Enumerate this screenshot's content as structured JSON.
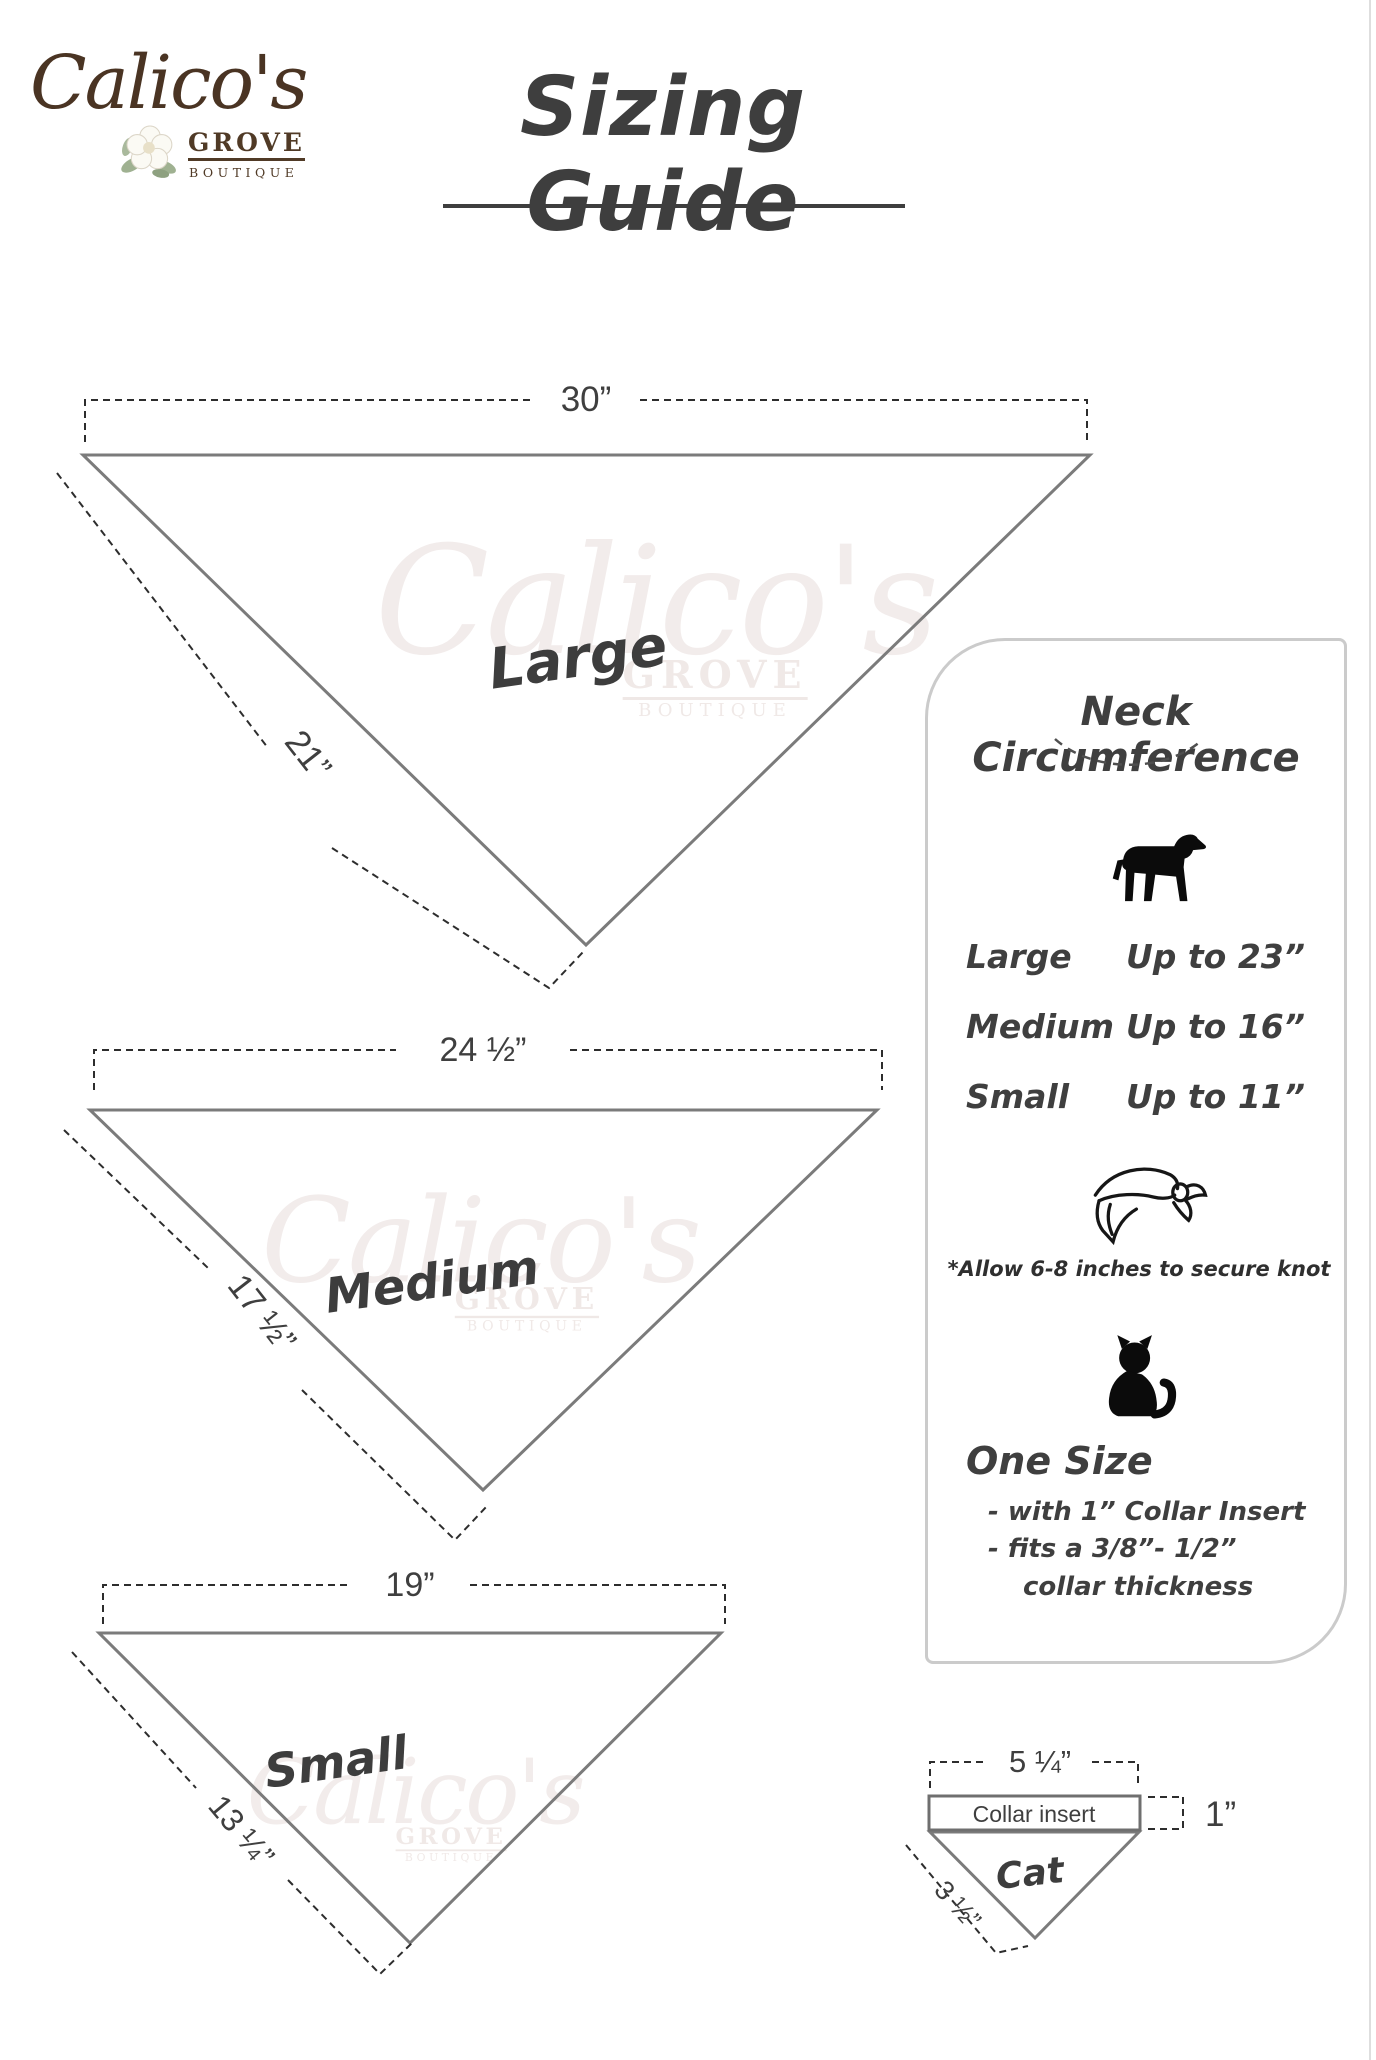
{
  "logo": {
    "name": "Calico's",
    "grove": "GROVE",
    "boutique": "BOUTIQUE",
    "flower_icon": "magnolia-flower",
    "brand_color": "#4a3423"
  },
  "title": {
    "text": "Sizing Guide"
  },
  "watermark": {
    "script": "Calico's",
    "grove": "GROVE",
    "boutique": "BOUTIQUE"
  },
  "bandanas": [
    {
      "label": "Large",
      "top_width": "30”",
      "side_length": "21”"
    },
    {
      "label": "Medium",
      "top_width": "24 ½”",
      "side_length": "17 ½”"
    },
    {
      "label": "Small",
      "top_width": "19”",
      "side_length": "13 ¼”"
    }
  ],
  "panel": {
    "heading": "Neck Circumference",
    "dog_icon": "dog-silhouette",
    "rows": [
      {
        "size": "Large",
        "value": "Up to 23”"
      },
      {
        "size": "Medium",
        "value": "Up to 16”"
      },
      {
        "size": "Small",
        "value": "Up to 11”"
      }
    ],
    "bandana_icon": "tied-bandana",
    "note": "*Allow 6-8 inches to secure knot",
    "cat_icon": "cat-silhouette",
    "one_size": {
      "heading": "One Size",
      "line1": "- with 1” Collar Insert",
      "line2": "- fits a 3/8”- 1/2”",
      "line3": "collar thickness"
    }
  },
  "cat_diagram": {
    "label": "Cat",
    "top_width": "5 ¼”",
    "insert_label": "Collar insert",
    "insert_height": "1”",
    "side_length": "3 ½”"
  },
  "colors": {
    "ink": "#3f3f3f",
    "line_gray": "#7b7b7b",
    "dash": "#2d2d2d",
    "brand_brown": "#4a3423",
    "panel_border": "#cbcbcb"
  }
}
